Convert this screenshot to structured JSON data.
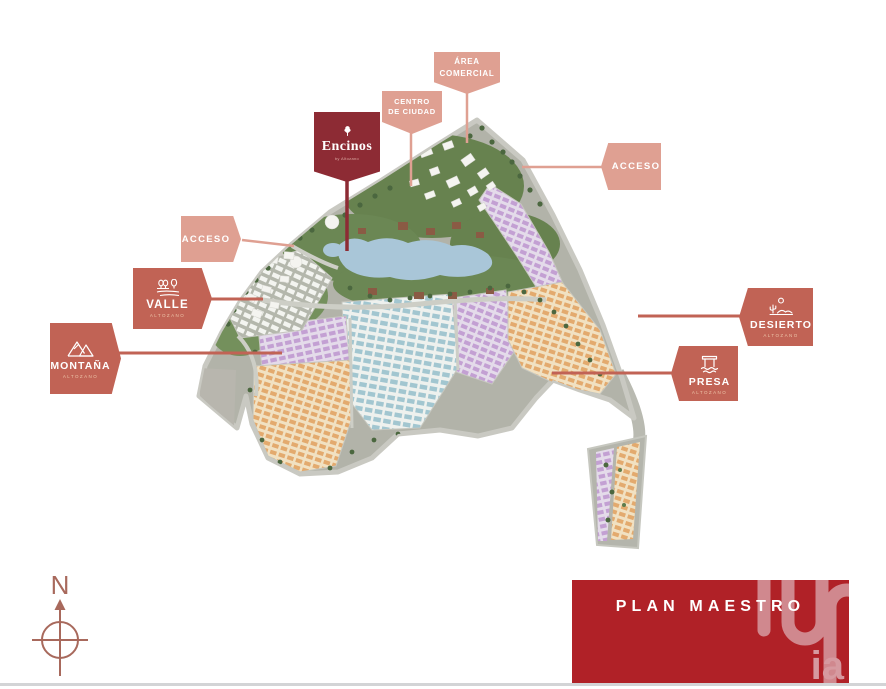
{
  "tags": {
    "area_comercial": {
      "line1": "ÁREA",
      "line2": "COMERCIAL"
    },
    "centro_ciudad": {
      "line1": "CENTRO",
      "line2": "DE CIUDAD"
    },
    "acceso_right": {
      "label": "ACCESO"
    },
    "acceso_left": {
      "label": "ACCESO"
    },
    "encinos": {
      "name": "Encinos",
      "subtitle": "by Altozano"
    },
    "valle": {
      "name": "VALLE",
      "brand": "ALTOZANO"
    },
    "montana": {
      "name": "MONTAÑA",
      "brand": "ALTOZANO"
    },
    "desierto": {
      "name": "DESIERTO",
      "brand": "ALTOZANO"
    },
    "presa": {
      "name": "PRESA",
      "brand": "ALTOZANO"
    }
  },
  "compass": {
    "north_label": "N"
  },
  "footer": {
    "title": "PLAN MAESTRO",
    "logo_text": "ia"
  },
  "colors": {
    "tag_light_salmon": "#dfa092",
    "tag_terracotta": "#c16355",
    "tag_maroon": "#8d2b34",
    "banner_red": "#b02127",
    "logo_pink": "#d69aa0",
    "compass": "#a8695c",
    "lake_blue": "#a9c6d8",
    "forest_green": "#67824f",
    "district_purple": "#c3a0d3",
    "district_orange": "#e3aa6e",
    "district_blue": "#a2c6d0",
    "road_gray": "#c9c9c2"
  }
}
